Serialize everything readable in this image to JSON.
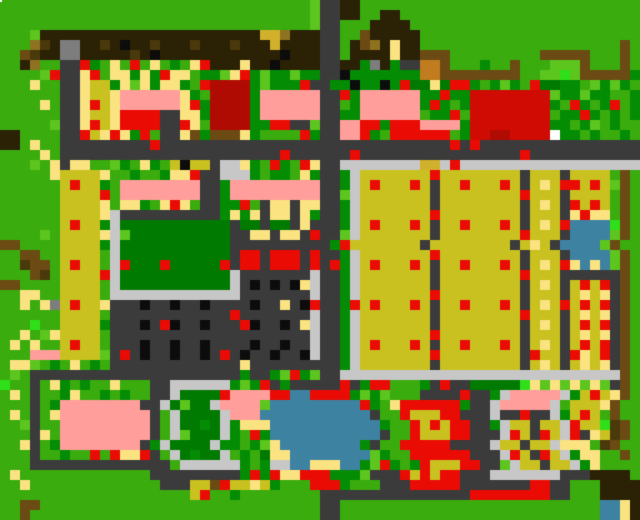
{
  "map": {
    "grid_width": 64,
    "grid_height": 52,
    "tile_size": 10,
    "palette": {
      ".": "#3aac0e",
      "g": "#5cc51e",
      "L": "#2fe019",
      "d": "#048c04",
      "D": "#017a02",
      "k": "#2b2104",
      "n": "#4a390b",
      "b": "#6b4b13",
      "c": "#8f7220",
      "o": "#c07c1e",
      "q": "#d1b12c",
      "y": "#fbe381",
      "Y": "#c8c11f",
      "r": "#ea0b04",
      "R": "#b00b02",
      "C": "#cf0b04",
      "p": "#ff9e9b",
      "w": "#ffffff",
      "s": "#3b3b3b",
      "S": "#c7c7c7",
      "m": "#7d7d7d",
      "B": "#0c0c0c",
      "W": "#3e82a2"
    },
    "legend": {
      ".": "grass",
      "g": "light-grass",
      "L": "bright-grass",
      "d": "bush-dark-green",
      "D": "garden-deep-green",
      "k": "tree-canopy-dark-brown",
      "n": "dark-brown",
      "b": "branch-brown",
      "c": "khaki-brown",
      "o": "orange-crate",
      "q": "gold",
      "y": "pale-yellow-path",
      "Y": "olive-crop-field",
      "r": "red-item",
      "R": "dark-red-building",
      "C": "crimson-building",
      "p": "pink-roof",
      "w": "white",
      "s": "asphalt-road",
      "S": "light-gray-sidewalk",
      "m": "gray-statue",
      "B": "black-dot",
      "W": "water"
    },
    "rows": [
      "...............................gsskk............................",
      "...............................gsskk..kk........................",
      "...............................gss...kkkk.......................",
      "...gkkkkkkkkkkkkkkkkkkkkkkqqckkkss..bkkkkk......................",
      "...cnkmmkknkBkknkkknkkknkkkqkkkkss.kbckykk....................b.",
      "..bnkkmmkkkkknkBkkkkkkkkkkkkBkkkss.kkkkykkbbb.........bbbbb...b.",
      "..kc..ssrd.y.r.y.d.yrkkkykkBkkkksskkdmkdssoob...d..b...gggb...b.",
      "....grssyr.yydydryy.ddgyrdgddgddssBdddddddoobbbbbbbb..ggLgbbbbbd",
      "...y..ssyYYdygydyyd.rRRRRdgdddrssddBddBdrDDyDrrd.dgd.rDDdd.gdgd.",
      "......ssyYYyppppppyd.RRRRdppppppssrdppppppddrddCCCCCCCCgddgdd..d",
      "....y.ssyrYyppppppyrdRRRRdppppppss.dppppppdrd.dCCCCCCCCd.rd.dr.d",
      "......ssyYYyrrrrssyydRRRRdppppppssddpppppp.ddr.CCCCCCCC.ddrd.d.d",
      ".....gssyrYyrrrrssry.RRRRddrrssgsspprrdrrrppppdCCCCCCCCdd.dg.d..",
      "kk....ssrYyrydr.ssybdbbbyd....rdsspprd.rrrrrr.dCCRRCCCCwdd.d..d.",
      "kk.y..sssssssssrsssssssssssssssssssssssssssssrsrssssssssssssssss",
      "....y.ssssssssssssssssssssssrssssssrssssssssssssssssrsssssssssss",
      "...g.ysyy..gd.yd.YBYYsSSyd.rd.ryssSSSSSSSSqqSrSSSSSSSSSSSSSSSSSS",
      ".....yYYYYy..d..dyyrssSSSd.dd.ydssdSYYYYYYYrYYYYYYYYsYYYsYYYY.b.",
      "......YrYYd.ppppppppssdpppppppppssdSYrYYYrYsYYrYYYrYsYyYrrYrYgb.",
      "......YYYYr.ppppppppssdpppppppppssgSYYYYYYYsYYYYYYYYrYYYsYYYY.b.",
      "......YYYYy.yyd.yry.ssddr.syysyyssdSYYYYYYYsYYYYYYYYsYyYsrYrY.b.",
      "......YYYYySssssssssssdydysyysydssdSYYYYYYYrYYYYYYYYsYYYsyryy.b.",
      "......YrYYdSDDDDDDDDDDDsDDsDDsysssdSYrYYYrYsYYrYYYrYsYyYrWWWWLb.",
      "....g.YYYYySgDDDDDDDDDDssyysyysrssgSYYYYYYYsYYYYYYYYrYYYsWWWWgb.",
      "bb....YYYYdSDDDDDDDDDDDssssssssssdrYYYYYYYsYYYYYYYYsYyYsWWWWgb.",
      "..bb..YYYY.SDDDDDDDDDDDsrrsrrrsrssdSYYYYYYYrYYYYYYYYsYYYsWWWWgb.",
      "..nbb.YrYY.SrDDDrDDDDDrsrrsrrrsrsrdSYrYYYrYsYYrYYYrYsYyYryWyWgb.",
      "...bn.YYYYrSDDDDDDDDDDDSsssssssSssdSYYYYYYYsYYYYYYYYrYYYssssssb.",
      "bb....YYYY.SDDDDDDDDDDDSsBsBsBySssdSYYYYYYYsYYYYYYYYsYyYsYrYrsb.",
      "..yy..YYYY.SSSSSSSSSSSSSsssssssSssdSYYYYYYYrYYYYYYYYsYYYsYyYysb.",
      "..y.ymYrYYysssBssBssBssssBssysBrssdrYrYYYrYsYYrYYYrYsYyYrYrYrsb.",
      "......YYYY.ssssssssssssrsssssssSssdSYYYYYYYsYYYYYYYYrYYYsYyYysb.",
      "...L..YYYYdsssBsrBssBsssrBssBsySssdSYYYYYYYsYYYYYYYYsYyYsYrYrsb.",
      "..y.gyYYYY.ssssssssssssssssssssSssdSYYYYYYYrYYYYYYYYsYYYsYyYysb.",
      ".y.y..YrYY.sssBssBssBssssBssBssSssdSYrYYYrYsYYrYYYrYsYyYsYrYrsb.",
      "...pppYYYYgsrsBssBssBsrsBssBssBSssdSYYYYYYYrYYYYYYYYsrYYsryYrsb.",
      ".yyg.d.y.d.sssssssssssssysssssssssdSYYYYYYYsYYYYYYYYsYyYsYyYysb.",
      ".g.sssssssssssssssssssssdssdgrdgssSSSSSSSSSSSSSSSSSSSSSSSSSSSSb.",
      "L..s.yd.d..y...ssSSSSSSdgdrsdsssssrsdrr...dsrssDDDDDLygygygygsb.",
      ".y.s..dy..d.d..ssSDDDDrpppprrWWrrrrdgdg...ssssrssdSpppppSdYrYyb.",
      "...s.dppppppppssSDgDDSppppgWWWWWWWWWrd.yrrrrrrdssSpppppS.YYYyb.",
      ".y.s.yppppppppps.SDDDDSpppWWWWWWWWWWWs..rYYYrrsssSssrssSdYrY.b.",
      "..gs..ppppppppps.SDDdDSdyyyWWWWWWWWWWWd..rYrYrrssdSYYsYYSrYYLnb.",
      "...sy.ppppppppps.SgDDDSd.rdWWWWWWWWWWWs..rYYYrrsssSrYsrYSrsyYnb.",
      "..ys.dppppppppsdSDDDDSdd.dgyWWWWWWWWds..rrrrrssssSYYsYYSyyy.nb.",
      "...s..d..r.ryyrs.SDdDDS.d.DyyWWWWWWWWgd..rrrrrrsssSrYsrYSdyy..b.",
      "...ssssssssssssss.SSSSSSd.dSSWWyyyWWdgrd.drYYYrrssgSYYsYYSdy.....",
      ".y.............sssssssssdrdryyrrrdddgsssrYrYrrsssSSSSSSSssskkkk",
      "..y.............sssYYbrYYyYd...rrrd...sssrrrrrsssssssrrss...kkkk",
      "...................Yr..d........sssssssssssssssrrrrrrrrss...kkkk",
      "..bb............................ss..........................WWyk",
      "..b.............................ss..........................WWyk"
    ],
    "cursor_dot": {
      "x": 0,
      "y": 0,
      "w": 2,
      "h": 2,
      "color": "#ffffff"
    }
  }
}
